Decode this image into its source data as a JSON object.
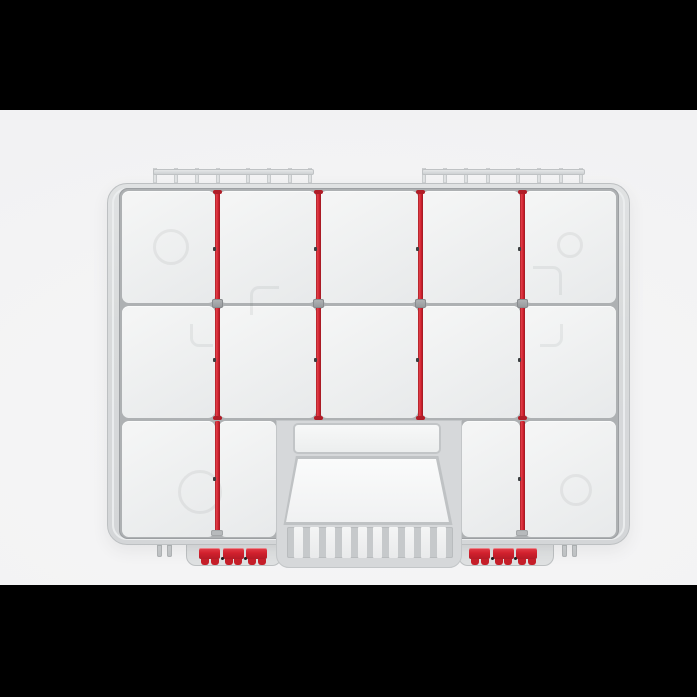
{
  "scene": {
    "description": "Letterboxed product photo: top view of a light-gray plastic parts organizer case with red adjustable dividers, two top hinges, a center carry handle with ribbed grip, and two red front latches. No visible text.",
    "letterbox": {
      "top_height": 110,
      "bottom_height": 112
    }
  },
  "palette": {
    "letterbox": "#000000",
    "backdrop": "#f2f2f3",
    "rim": "#d8dadb",
    "rim_stroke": "#bdc0c2",
    "rim_light": "#eceeef",
    "panel_a": "#f4f5f5",
    "panel_b": "#e8eaeb",
    "line": "#aeb1b3",
    "red": "#d2212e",
    "red_dark": "#9b1922",
    "red_light": "#e2404a",
    "clip_gray": "#a4a7aa",
    "notch": "#3c3f41",
    "latch_dot": "#1d1d1f"
  },
  "organizer": {
    "compartment_rows": 3,
    "rows": [
      {
        "top": 191,
        "bottom": 303,
        "segments": [
          [
            122,
            215
          ],
          [
            219,
            316
          ],
          [
            320,
            418
          ],
          [
            422,
            520
          ],
          [
            524,
            616
          ]
        ]
      },
      {
        "top": 306,
        "bottom": 418,
        "segments": [
          [
            122,
            215
          ],
          [
            219,
            316
          ],
          [
            320,
            418
          ],
          [
            422,
            520
          ],
          [
            524,
            616
          ]
        ]
      },
      {
        "top": 421,
        "bottom": 537,
        "segments": [
          [
            122,
            215
          ],
          [
            219,
            276
          ],
          [
            462,
            520
          ],
          [
            524,
            616
          ]
        ]
      }
    ],
    "dividers": {
      "upper": {
        "xs": [
          217,
          318,
          420,
          522
        ],
        "top": 191,
        "bottom": 419,
        "clip_y": 299,
        "notch_ys": [
          247,
          358
        ]
      },
      "lower": {
        "xs": [
          217,
          522
        ],
        "top": 421,
        "bottom": 536,
        "cap_y": 530,
        "notch_ys": [
          477
        ]
      }
    },
    "hinges": {
      "items": [
        {
          "left": 153,
          "width": 159
        },
        {
          "left": 422,
          "width": 161
        }
      ],
      "post_fractions": [
        0,
        0.135,
        0.27,
        0.405,
        0.6,
        0.735,
        0.87,
        1
      ]
    },
    "latches": {
      "xs": [
        199,
        469
      ],
      "top": 548,
      "width": 68,
      "segment_count": 3,
      "segment_lefts": [
        0,
        23.5,
        47
      ],
      "segment_width": 21,
      "tab_offsets": [
        2,
        11.5
      ],
      "dot_offsets": [
        21.5,
        45
      ]
    },
    "feet": {
      "pairs": [
        [
          157,
          167
        ],
        [
          562,
          572
        ]
      ],
      "top": 545
    },
    "grip_slats": 10,
    "emboss_marks": [
      {
        "shape": "circle",
        "x": 153,
        "y": 229,
        "size": 30
      },
      {
        "shape": "circle",
        "x": 557,
        "y": 232,
        "size": 20
      },
      {
        "shape": "circle",
        "x": 178,
        "y": 470,
        "size": 38
      },
      {
        "shape": "circle",
        "x": 560,
        "y": 474,
        "size": 26
      },
      {
        "shape": "corner-tl",
        "x": 250,
        "y": 286,
        "size": 26
      },
      {
        "shape": "corner-tr",
        "x": 533,
        "y": 266,
        "size": 26
      },
      {
        "shape": "corner-bl",
        "x": 190,
        "y": 324,
        "size": 20
      },
      {
        "shape": "corner-br",
        "x": 540,
        "y": 324,
        "size": 20
      }
    ]
  }
}
